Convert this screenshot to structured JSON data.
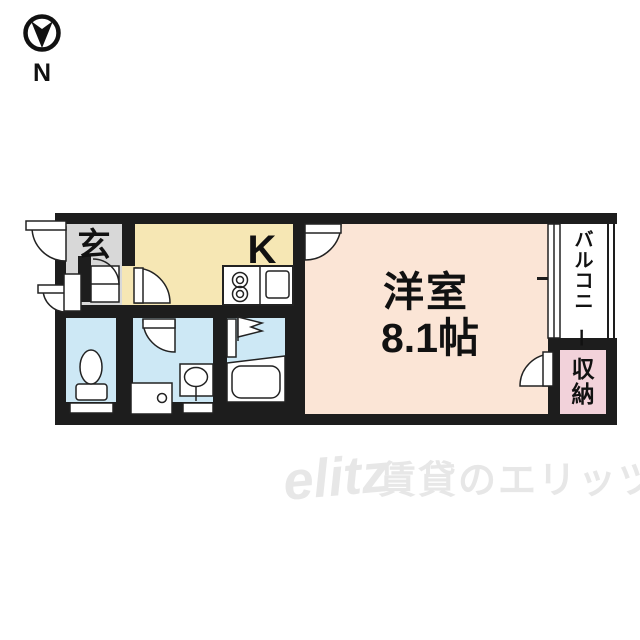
{
  "compass": {
    "label": "N"
  },
  "rooms": {
    "entrance": {
      "label": "玄"
    },
    "kitchen": {
      "label": "K"
    },
    "main_room": {
      "name": "洋室",
      "size": "8.1帖"
    },
    "balcony": {
      "label": "バルコニー"
    },
    "storage": {
      "label": "収納"
    }
  },
  "watermark": {
    "logo": "elitz",
    "text": "賃貸のエリッツ"
  },
  "colors": {
    "wall": "#1d1d1d",
    "entrance": "#d8d8d8",
    "kitchen": "#f6e7b4",
    "main_room": "#fbe5d6",
    "wet_area": "#cde8f5",
    "storage": "#f2d2da",
    "watermark": "#e7e7e7"
  }
}
